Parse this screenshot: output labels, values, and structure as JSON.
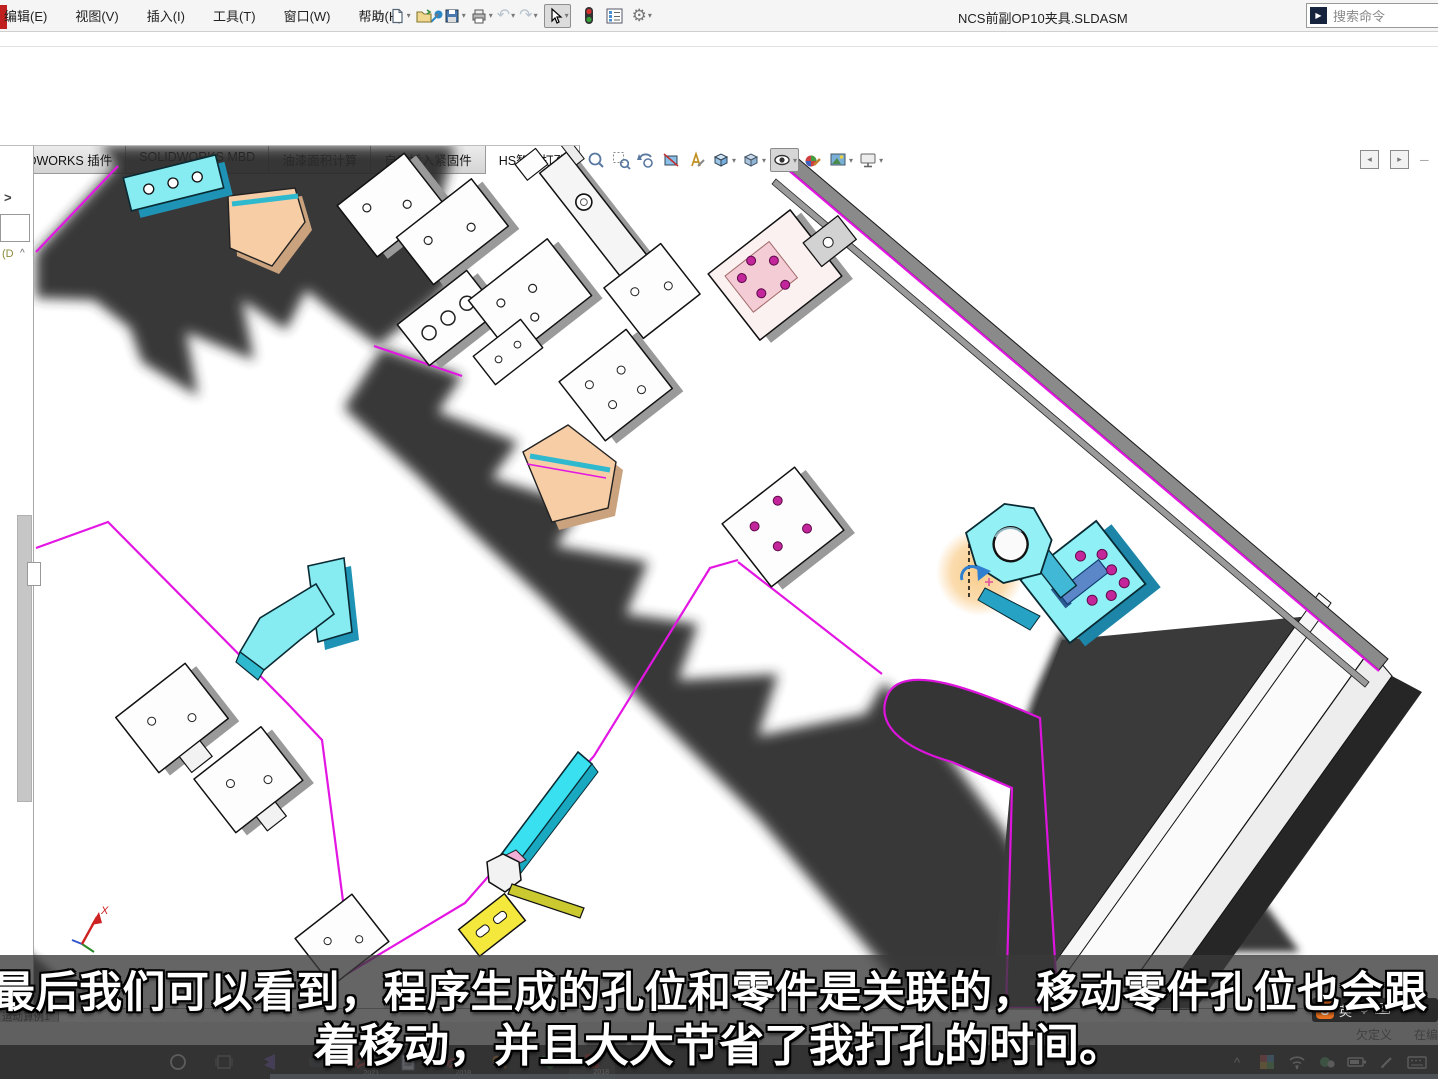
{
  "window": {
    "title": "NCS前副OP10夹具.SLDASM",
    "search_placeholder": "搜索命令"
  },
  "menu": {
    "items": [
      "编辑(E)",
      "视图(V)",
      "插入(I)",
      "工具(T)",
      "窗口(W)",
      "帮助(H)"
    ]
  },
  "toolbar": {
    "icons": [
      "pin",
      "home",
      "new-document",
      "open",
      "save",
      "print",
      "undo",
      "redo",
      "select-cursor",
      "rebuild-traffic-light",
      "display-pane-list",
      "options-gear"
    ]
  },
  "tabs": {
    "items": [
      {
        "label": "SOLIDWORKS 插件",
        "active": false
      },
      {
        "label": "SOLIDWORKS MBD",
        "active": false
      },
      {
        "label": "油漆面积计算",
        "active": false
      },
      {
        "label": "自动插入紧固件",
        "active": false
      },
      {
        "label": "HS智能打孔",
        "active": true
      }
    ]
  },
  "headsup": {
    "icons": [
      "zoom-to-fit",
      "zoom-to-area",
      "previous-view",
      "section-view",
      "annotation-view",
      "view-orientation",
      "display-style",
      "hide-show-items",
      "edit-appearance",
      "apply-scene",
      "view-settings"
    ]
  },
  "pane_controls": {
    "icons": [
      "collapse-left-pane",
      "collapse-right-pane",
      "minimize-pane"
    ]
  },
  "left_panel": {
    "expand_glyph": ">",
    "tree_label": "(D",
    "collapse_glyph": "^"
  },
  "viewport": {
    "axis_label_x": "X"
  },
  "subtitle": {
    "line1": "最后我们可以看到，程序生成的孔位和零件是关联的，移动零件孔位也会跟",
    "line2": "着移动，并且大大节省了我打孔的时间。"
  },
  "motion_bar": {
    "tab": "运动算例1"
  },
  "status_bar": {
    "items": [
      "欠定义",
      "在编辑"
    ]
  },
  "ime": {
    "logo": "S",
    "mode": "英"
  },
  "taskbar": {
    "apps": [
      {
        "name": "search-ring",
        "badge": ""
      },
      {
        "name": "task-view",
        "badge": ""
      },
      {
        "name": "vscode",
        "badge": ""
      },
      {
        "name": "folder",
        "badge": ""
      },
      {
        "name": "solidworks-2021",
        "badge": "2021"
      },
      {
        "name": "document",
        "badge": ""
      },
      {
        "name": "solidworks-2018",
        "badge": "2018"
      },
      {
        "name": "key-tool",
        "badge": ""
      },
      {
        "name": "wechat",
        "badge": ""
      },
      {
        "name": "solidworks-2018-red",
        "badge": "2018"
      }
    ],
    "tray": [
      "tray-expand",
      "photos",
      "wifi",
      "messenger",
      "battery",
      "pen",
      "touch-keyboard"
    ]
  },
  "colors": {
    "magenta": "#e316e3",
    "cyan": "#7de9f0",
    "peach": "#f6c9a2",
    "yellow": "#f2e43c",
    "highlight": "#f6b44a",
    "shadow": "#2c2c2c",
    "taskbar": "#1d1d1d",
    "subtitle_bg": "rgba(58,58,58,0.78)"
  }
}
